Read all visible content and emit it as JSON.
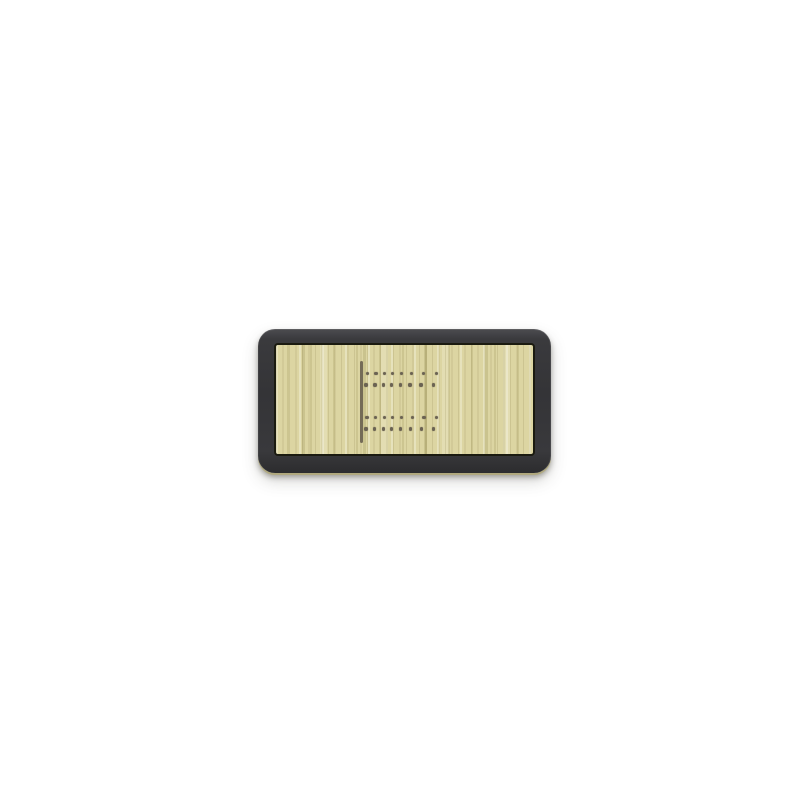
{
  "canvas": {
    "width": 807,
    "height": 807,
    "background_color": "#ffffff"
  },
  "plaque": {
    "x": 258,
    "y": 329,
    "width": 293,
    "height": 144,
    "corner_radius": 17,
    "frame_color": "#39393c",
    "frame_highlight_color": "#4c4c50",
    "inner_edge_color": "#1b1b10",
    "bottom_lip_color": "#b2a978",
    "shadow_color": "rgba(70,68,58,0.45)"
  },
  "wood": {
    "x": 274,
    "y": 343,
    "width": 261,
    "height": 113,
    "base_color": "#dcd5a2",
    "streak_dark_color": "#c9bf8a",
    "streak_light_color": "#eae4ba"
  },
  "start_line": {
    "x": 359.5,
    "y": 361,
    "width": 3.5,
    "height": 82,
    "color": "#746b57"
  },
  "peg_holes": {
    "dot_diameter": 3.4,
    "color": "#6b6353",
    "rows": [
      {
        "y": 373.5,
        "xs": [
          367.3,
          376.0,
          384.3,
          392.7,
          401.7,
          411.7,
          423.3,
          436.7
        ]
      },
      {
        "y": 385.0,
        "xs": [
          366.0,
          375.0,
          383.3,
          391.7,
          400.3,
          410.0,
          421.0,
          433.3
        ]
      },
      {
        "y": 417.5,
        "xs": [
          367.0,
          375.7,
          384.3,
          392.7,
          401.7,
          412.3,
          424.0,
          436.7
        ]
      },
      {
        "y": 429.0,
        "xs": [
          366.0,
          374.7,
          383.3,
          391.7,
          400.3,
          410.3,
          421.3,
          433.7
        ]
      }
    ]
  }
}
